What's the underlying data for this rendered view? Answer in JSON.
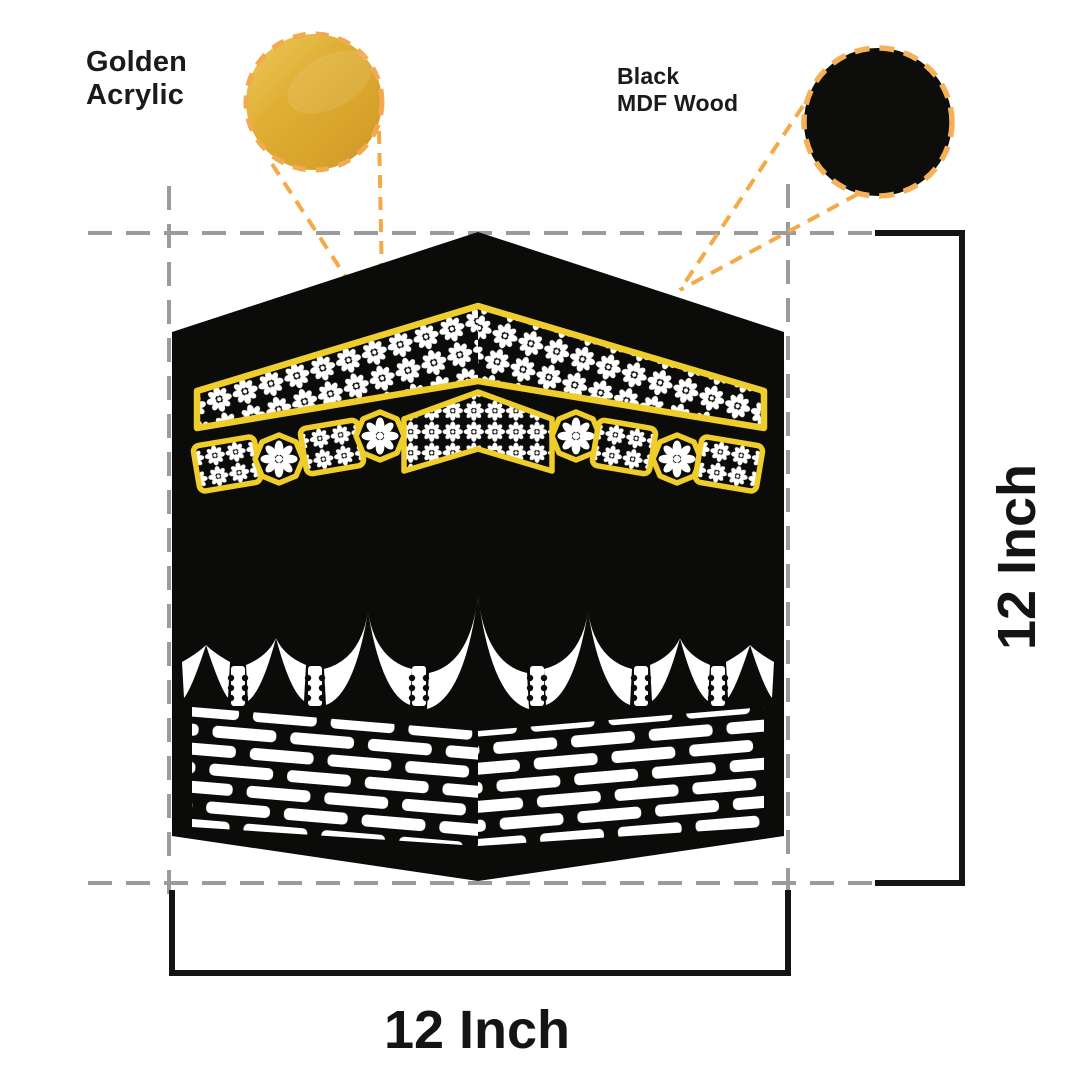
{
  "artwork": {
    "subject": "Kaaba silhouette wall art",
    "width_label": "12 Inch",
    "height_label": "12 Inch"
  },
  "callouts": {
    "golden_acrylic": {
      "line1": "Golden",
      "line2": "Acrylic"
    },
    "black_mdf": {
      "line1": "Black",
      "line2": "MDF Wood"
    }
  },
  "colors": {
    "artwork_black": "#0b0b09",
    "band_yellow": "#efce2b",
    "pointer_orange": "#f5a947",
    "gold_swatch": "#dfae33",
    "guide_gray": "#9b9b9b",
    "dimension_line": "#141414",
    "text": "#1b1b1b",
    "background": "#ffffff"
  }
}
